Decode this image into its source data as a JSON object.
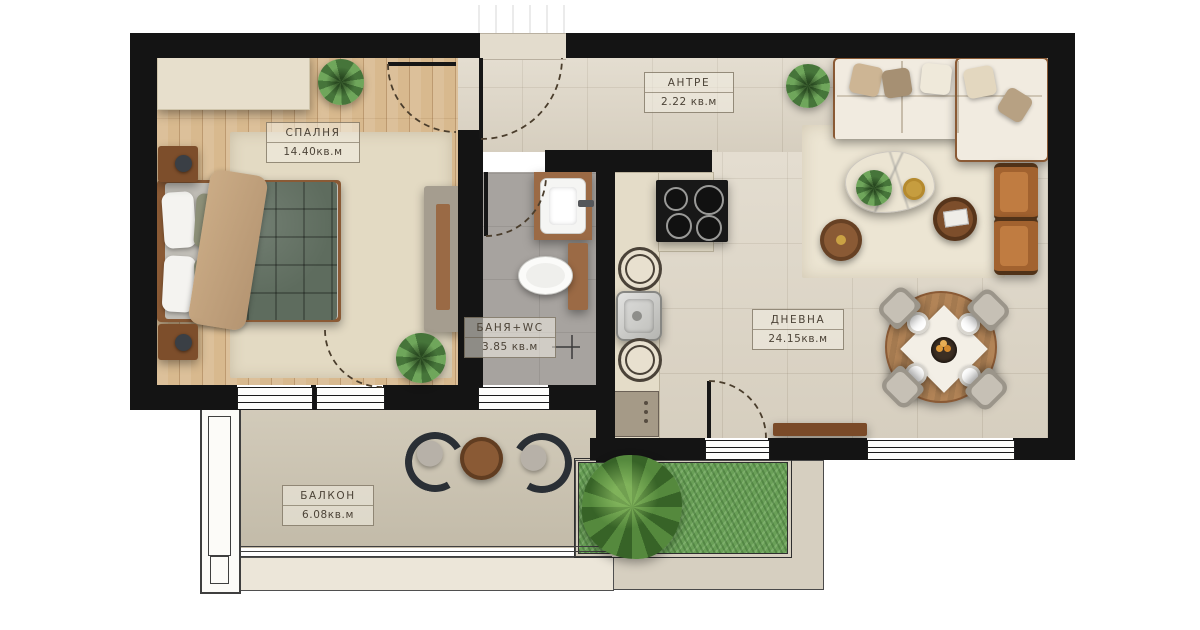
{
  "plan": {
    "type": "apartment-floor-plan",
    "language": "bg",
    "rooms": [
      {
        "key": "bedroom",
        "name": "СПАЛНЯ",
        "area": "14.40кв.м"
      },
      {
        "key": "hallway",
        "name": "АНТРЕ",
        "area": "2.22 кв.м"
      },
      {
        "key": "bathroom",
        "name": "БАНЯ+WC",
        "area": "3.85 кв.м"
      },
      {
        "key": "living_room",
        "name": "ДНЕВНА",
        "area": "24.15кв.м"
      },
      {
        "key": "balcony",
        "name": "БАЛКОН",
        "area": "6.08кв.м"
      }
    ],
    "colors": {
      "wall": "#141414",
      "bedroom_wood_floor": "#d8b98e",
      "living_tile_floor": "#ded6c6",
      "bathroom_floor": "#a7a39f",
      "balcony_floor": "#cdc5b2",
      "grass": "#6aa058",
      "accent_wood": "#8a5a35",
      "sofa_cream": "#f1ebe0",
      "label_text": "#4c4337"
    }
  }
}
